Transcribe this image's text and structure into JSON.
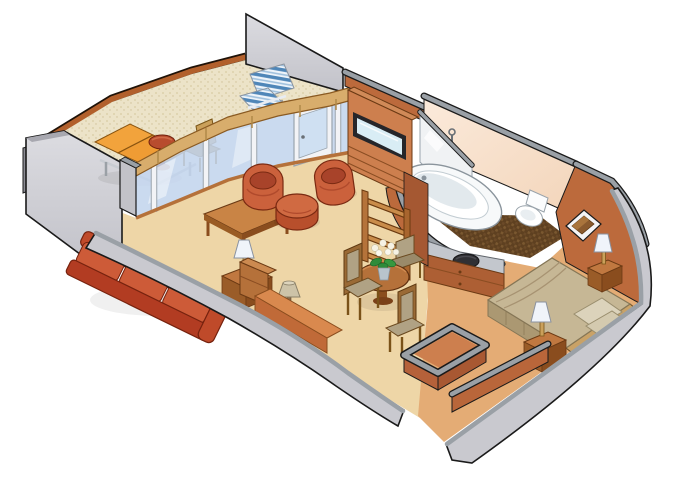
{
  "image": {
    "title": "Suite floor plan — isometric cutaway illustration",
    "type": "isometric-floor-plan",
    "background": "#ffffff",
    "width": 680,
    "height": 486
  },
  "palette": {
    "outline": "#1a1a1a",
    "wall_gray": "#c9c9cf",
    "wall_gray_cap": "#9aa0a6",
    "wall_gray_dark": "#8c8c94",
    "terracotta": "#bc6a3c",
    "terracotta_dark": "#a55832",
    "terracotta_light": "#cd7f4e",
    "glass": "#c3d5ed",
    "mullion": "#f2f3f6",
    "transom_wood": "#d8ad6c",
    "rail_wood": "#b2602c",
    "carpet": "#eed6a7",
    "floor_orange": "#e4ac75",
    "balcony_floor": "#ece3c8",
    "sofa_red": "#bf4a2a",
    "sofa_cushion": "#cd5b38",
    "chair_red": "#cb613c",
    "wood": "#b5713a",
    "wood_light": "#c98445",
    "wood_dark": "#8a4d1e",
    "bath_peach": "#f6ddc6",
    "fixture_white": "#f7f9fa",
    "bath_floor_dark": "#5e4020",
    "bed_khaki": "#c6b795",
    "bed_drape": "#ab9872",
    "pillow": "#dcd3bb",
    "headboard": "#c9a267",
    "lamp_white": "#f0f4fa",
    "lamp_tan": "#cdc3a8",
    "leaf_green": "#2e8b3a",
    "flower_white": "#f6f2e4",
    "stripe_blue": "#4f86b8",
    "lounger_orange": "#f2a33c",
    "tv_screen": "#d9edf5"
  },
  "rooms": [
    {
      "id": "veranda",
      "label": "Veranda / Balcony",
      "furniture": [
        "lounge-chair",
        "round-side-table",
        "wood-side-chair",
        "striped-deck-chair",
        "glass-railing",
        "privacy-partition"
      ]
    },
    {
      "id": "living-room",
      "label": "Living Room",
      "furniture": [
        "sofa",
        "coffee-table",
        "barrel-chair-left",
        "barrel-chair-right",
        "ottoman",
        "side-table",
        "table-lamp",
        "floor-lamp",
        "writing-desk",
        "tv-cabinet",
        "shelf-unit",
        "balcony-door"
      ]
    },
    {
      "id": "dining-area",
      "label": "Dining Area",
      "furniture": [
        "dining-table",
        "dining-chair-left",
        "dining-chair-back",
        "dining-chair-front",
        "flower-vase"
      ]
    },
    {
      "id": "bathroom",
      "label": "Bathroom",
      "furniture": [
        "bathtub",
        "toilet",
        "shower-panel",
        "shower-fixture",
        "vanity-sink",
        "vanity-cabinet",
        "tiled-floor"
      ]
    },
    {
      "id": "bedroom",
      "label": "Bedroom",
      "furniture": [
        "bed",
        "pillows",
        "headboard",
        "nightstand-front",
        "nightstand-back",
        "table-lamp-front",
        "table-lamp-back",
        "wall-art"
      ]
    },
    {
      "id": "entry",
      "label": "Entry / Corridor",
      "furniture": [
        "closet-enclosure",
        "corridor-wall",
        "entry-door-opening"
      ]
    }
  ]
}
